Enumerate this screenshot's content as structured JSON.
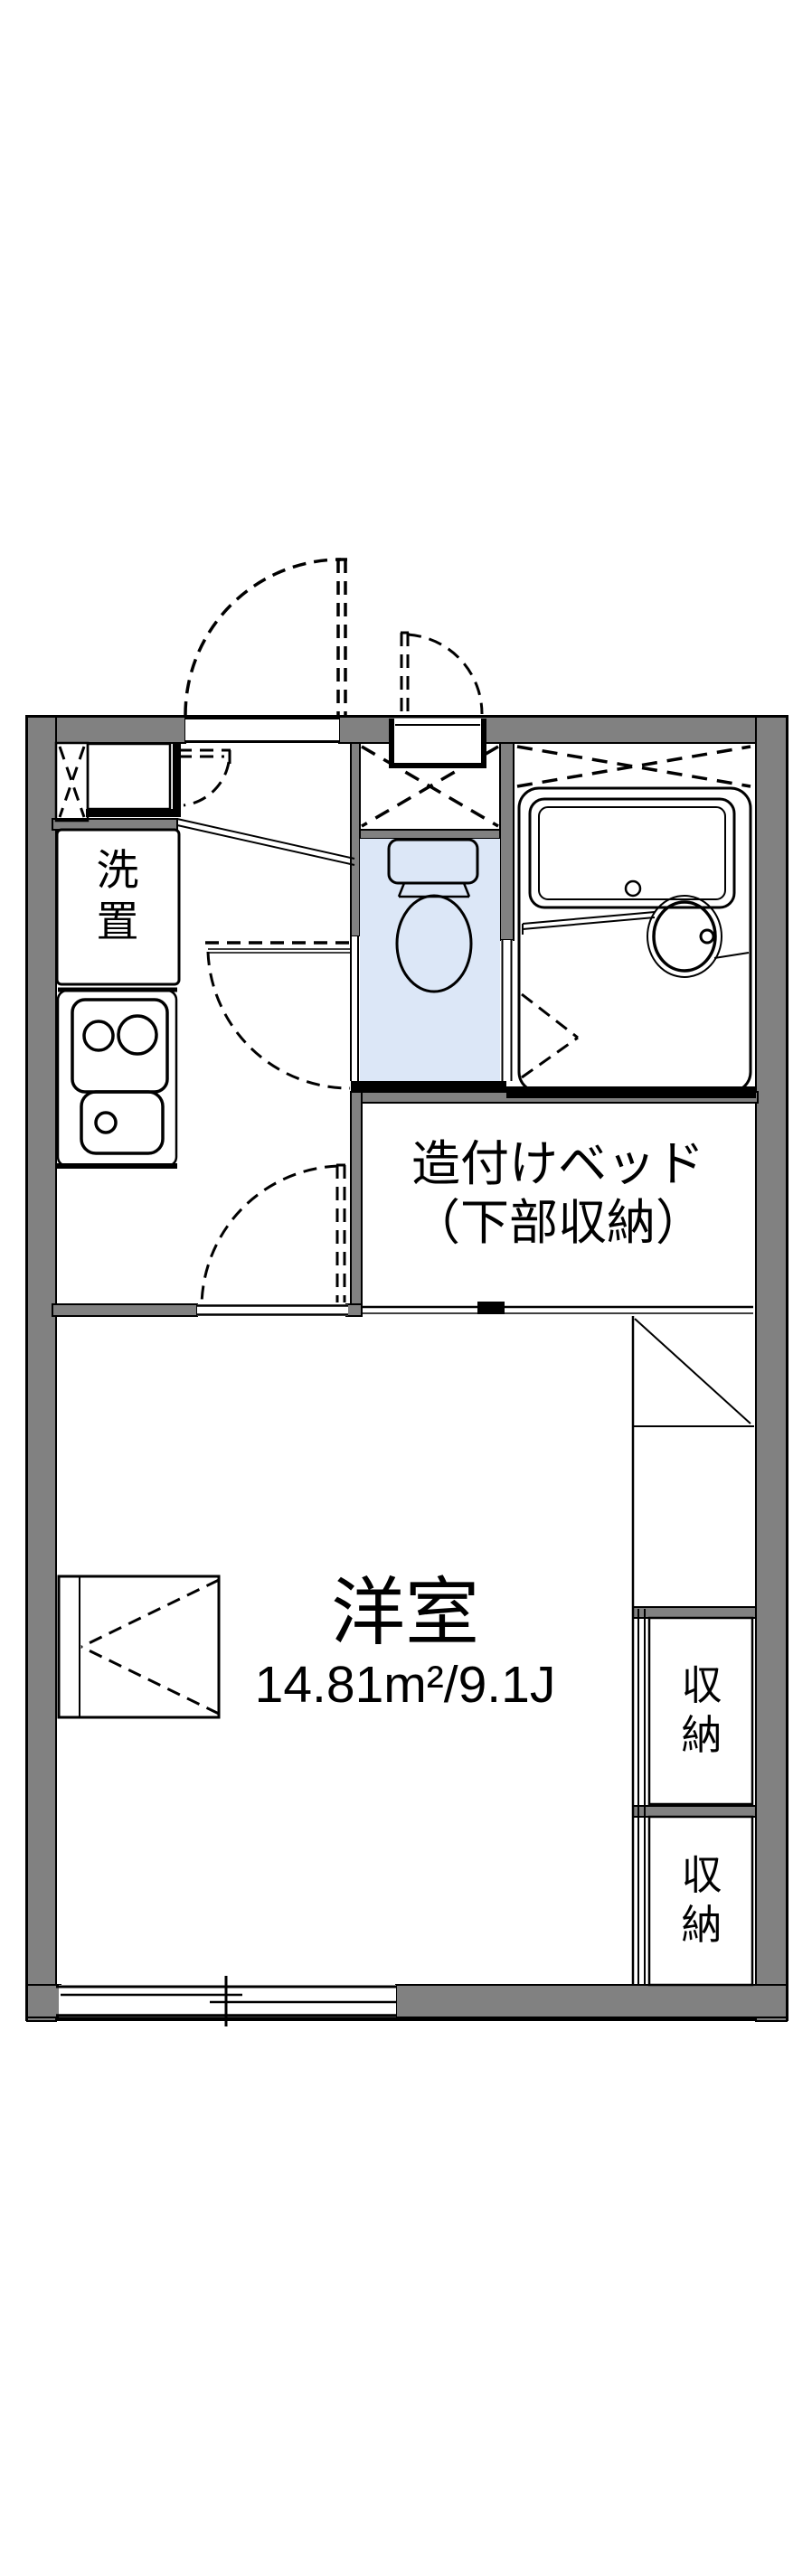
{
  "title": "apartment-floor-plan",
  "colors": {
    "wall": "#818181",
    "ink": "#000000",
    "room_blue": "#dce7f7",
    "fixture_blue": "#e9effb",
    "cream": "#fcf2dc",
    "bg": "#ffffff"
  },
  "labels": {
    "washer": "洗置",
    "bed_line1": "造付けベッド",
    "bed_line2": "（下部収納）",
    "room_name": "洋室",
    "room_area": "14.81m²/9.1J",
    "storage_upper": "収納",
    "storage_lower": "収納"
  }
}
